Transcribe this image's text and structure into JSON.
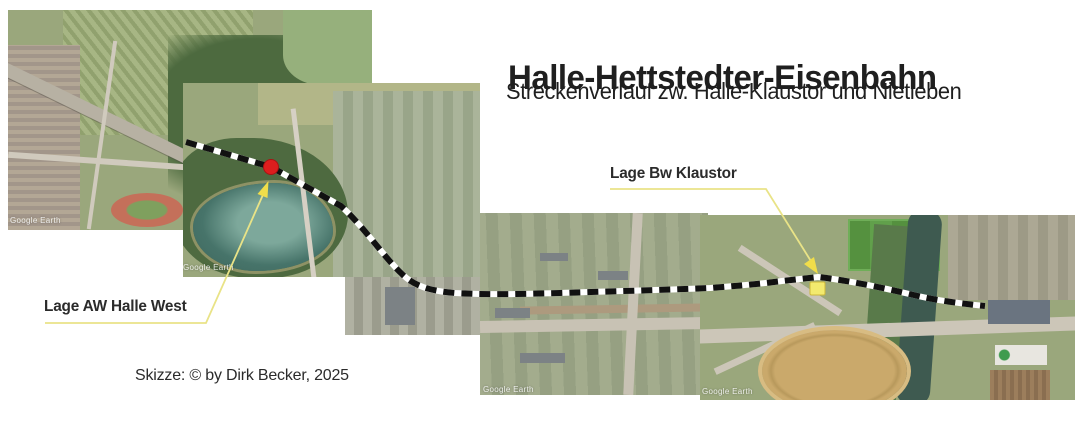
{
  "title": "Halle-Hettstedter-Eisenbahn",
  "subtitle": "Streckenverlauf zw. Halle-Klaustor und Nietleben",
  "credit": "Skizze: © by Dirk Becker, 2025",
  "annotations": {
    "bw_klaustor": {
      "label": "Lage Bw Klaustor"
    },
    "aw_halle_west": {
      "label": "Lage AW Halle West"
    }
  },
  "watermarks": {
    "google_earth": "Google Earth"
  },
  "colors": {
    "annotation_yellow": "#e9e387",
    "arrow_yellow": "#f0dd4a",
    "aw_marker_red": "#dd1e1e",
    "bw_marker_yellow": "#f3ea6e",
    "route_black": "#111111",
    "route_white": "#ffffff"
  }
}
